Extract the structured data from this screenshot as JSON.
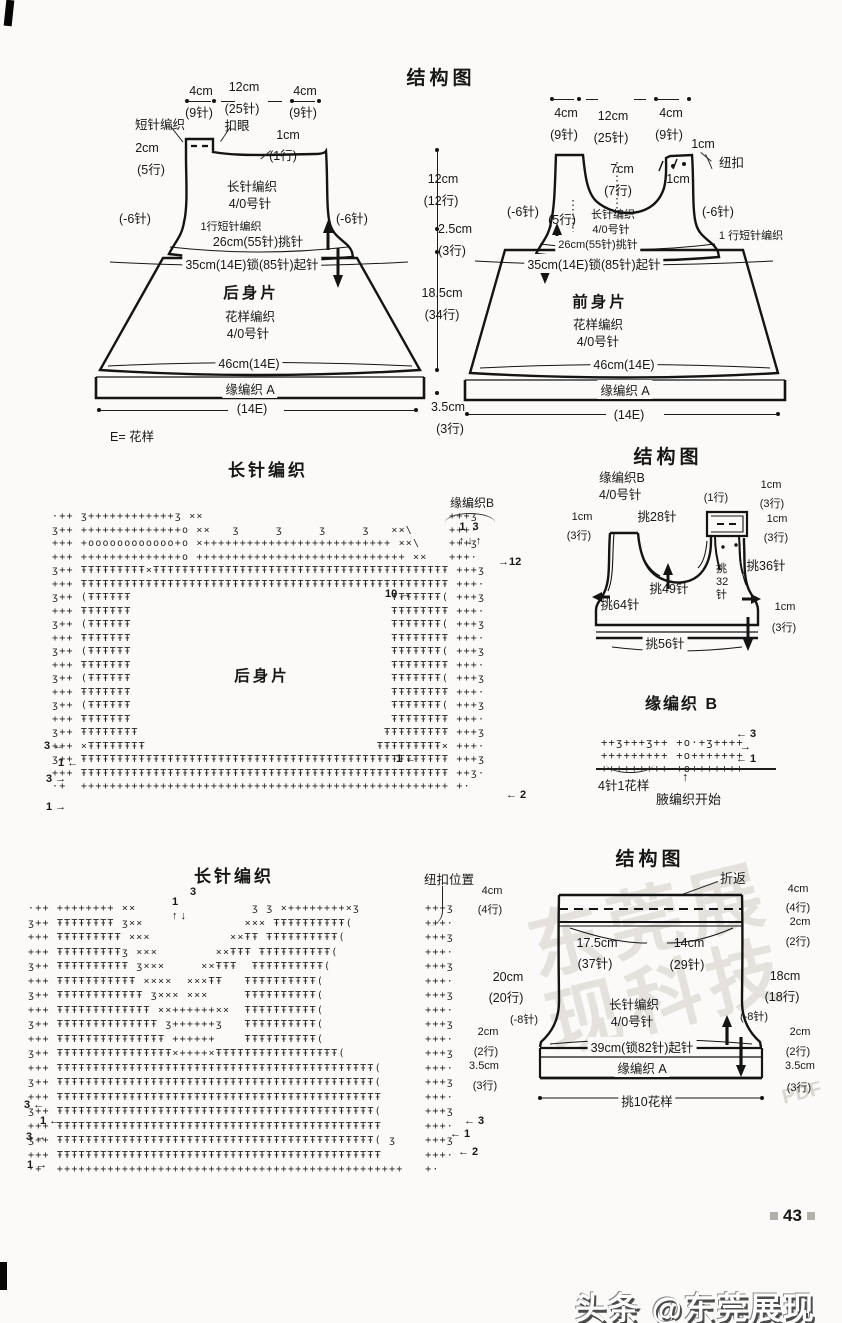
{
  "top": {
    "title": "结构图",
    "back": {
      "w_left": "4cm",
      "w_left_n": "(9针)",
      "w_mid": "12cm",
      "w_mid_n": "(25针)",
      "w_right": "4cm",
      "w_right_n": "(9针)",
      "sc_band": "短针编织",
      "buttonhole": "扣眼",
      "tab_h": "2cm",
      "tab_h_n": "(5行)",
      "edge_h": "1cm",
      "edge_h_n": "(1行)",
      "stitch": "长针编织",
      "hook": "4/0号针",
      "dec_left": "(-6针)",
      "dec_right": "(-6针)",
      "sc_row": "1行短针编织",
      "pickup": "26cm(55针)挑针",
      "cast_on": "35cm(14E)锁(85针)起针",
      "name": "后身片",
      "pattern": "花样编织",
      "hook2": "4/0号针",
      "hem_w": "46cm(14E)",
      "edging": "缘编织 A",
      "hem_dim": "(14E)",
      "legend": "E= 花样"
    },
    "front": {
      "w_left": "4cm",
      "w_left_n": "(9针)",
      "w_mid": "12cm",
      "w_mid_n": "(25针)",
      "w_right": "4cm",
      "w_right_n": "(9针)",
      "btn_h1": "1cm",
      "button": "纽扣",
      "btn_h2": "1cm",
      "neck_d": "7cm",
      "neck_d_n": "(7行)",
      "dec_left": "(-6针)",
      "rows5": "(5行)",
      "dec_right": "(-6针)",
      "stitch": "长针编织",
      "hook": "4/0号针",
      "pickup": "26cm(55针)挑针",
      "sc_row": "1 行短针编织",
      "cast_on": "35cm(14E)锁(85针)起针",
      "name": "前身片",
      "pattern": "花样编织",
      "hook2": "4/0号针",
      "hem_w": "46cm(14E)",
      "edging": "缘编织 A",
      "hem_dim": "(14E)"
    },
    "mid": {
      "h1": "12cm",
      "h1n": "(12行)",
      "h2": "2.5cm",
      "h2n": "(3行)",
      "h3": "18.5cm",
      "h3n": "(34行)",
      "h4": "3.5cm",
      "h4n": "(3行)"
    }
  },
  "chart_back": {
    "title": "长针编织",
    "edge_label": "缘编织B",
    "cols": "1   3",
    "arrows": "↑ ↓ ↑",
    "r12": "→12",
    "r10": "10 →",
    "center": "后身片",
    "ln1": "3 ←",
    "ln2": "1 ←",
    "ln3": "3 →",
    "ln4": "1 →",
    "rn1": "1 ←",
    "rn2": "← 2",
    "ascii": "·++ ʒ++++++++++++ʒ ××                                  +++ʒ\nʒ++ ++++++++++++++o ××   ʒ     ʒ     ʒ     ʒ   ××\\     +++·\n+++ +oooooooooooo+o ×++++++++++++++++++++++++++ ××\\    +++ʒ\n+++ ++++++++++++++o +++++++++++++++++++++++++++++ ××   +++·\nʒ++ ŦŦŦŦŦŦŦŦŦ×ŦŦŦŦŦŦŦŦŦŦŦŦŦŦŦŦŦŦŦŦŦŦŦŦŦŦŦŦŦŦŦŦŦŦŦŦŦŦŦŦŦ +++ʒ\n+++ ŦŦŦŦŦŦŦŦŦŦŦŦŦŦŦŦŦŦŦŦŦŦŦŦŦŦŦŦŦŦŦŦŦŦŦŦŦŦŦŦŦŦŦŦŦŦŦŦŦŦŦ +++·\nʒ++ (ŦŦŦŦŦŦ                                    ŦŦŦŦŦŦŦ( +++ʒ\n+++ ŦŦŦŦŦŦŦ                                    ŦŦŦŦŦŦŦŦ +++·\nʒ++ (ŦŦŦŦŦŦ                                    ŦŦŦŦŦŦŦ( +++ʒ\n+++ ŦŦŦŦŦŦŦ                                    ŦŦŦŦŦŦŦŦ +++·\nʒ++ (ŦŦŦŦŦŦ                                    ŦŦŦŦŦŦŦ( +++ʒ\n+++ ŦŦŦŦŦŦŦ                                    ŦŦŦŦŦŦŦŦ +++·\nʒ++ (ŦŦŦŦŦŦ                                    ŦŦŦŦŦŦŦ( +++ʒ\n+++ ŦŦŦŦŦŦŦ                                    ŦŦŦŦŦŦŦŦ +++·\nʒ++ (ŦŦŦŦŦŦ                                    ŦŦŦŦŦŦŦ( +++ʒ\n+++ ŦŦŦŦŦŦŦ                                    ŦŦŦŦŦŦŦŦ +++·\nʒ++ ŦŦŦŦŦŦŦŦ                                  ŦŦŦŦŦŦŦŦŦ +++ʒ\n+++ ×ŦŦŦŦŦŦŦŦ                                ŦŦŦŦŦŦŦŦŦ× +++·\nʒ++ ŦŦŦŦŦŦŦŦŦŦŦŦŦŦŦŦŦŦŦŦŦŦŦŦŦŦŦŦŦŦŦŦŦŦŦŦŦŦŦŦŦŦŦŦŦŦŦŦŦŦŦ +++ʒ\n+++ ŦŦŦŦŦŦŦŦŦŦŦŦŦŦŦŦŦŦŦŦŦŦŦŦŦŦŦŦŦŦŦŦŦŦŦŦŦŦŦŦŦŦŦŦŦŦŦŦŦŦŦ ++ʒ·\n·+  +++++++++++++++++++++++++++++++++++++++++++++++++++ +·"
  },
  "vest": {
    "title": "结构图",
    "edge": "缘编织B",
    "hook": "4/0号针",
    "row1": "(1行)",
    "cm_t": "1cm",
    "cm_t_n": "(3行)",
    "p28": "挑28针",
    "cm_l": "1cm",
    "cm_l_n": "(3行)",
    "cm_r": "1cm",
    "cm_r_n": "(3行)",
    "p36": "挑36针",
    "p49": "挑49针",
    "p32": "挑32针",
    "p64": "挑64针",
    "cm_b": "1cm",
    "cm_b_n": "(3行)",
    "p56": "挑56针"
  },
  "edge_b": {
    "title": "缘编织 B",
    "a3": "← 3",
    "amid": "→",
    "a1": "← 1",
    "up": "↑",
    "unit": "4针1花样",
    "start": "腋编织开始",
    "ascii": "++ʒ+++ʒ++ +o·+ʒ++++\n+++++++++ +o+++++++\n+++++++++ +o+++++++"
  },
  "chart_front": {
    "title": "长针编织",
    "btn_pos": "纽扣位置",
    "n1": "1",
    "n3": "3",
    "arr": "↑ ↓",
    "ln1": "3 ←",
    "ln2": "1 ←",
    "ln3": "3 →",
    "ln4": "1 →",
    "rn1": "← 3",
    "rn2": "← 1",
    "rn3": "← 2",
    "ascii": "·++ ++++++++ ××                ʒ ʒ ×++++++++×ʒ         +++ʒ\nʒ++ ŦŦŦŦŦŦŦŦ ʒ××              ××× ŦŦŦŦŦŦŦŦŦŦ(          +++·\n+++ ŦŦŦŦŦŦŦŦŦ ×××           ××ŦŦ ŦŦŦŦŦŦŦŦŦŦ(           +++ʒ\n+++ ŦŦŦŦŦŦŦŦŦʒ ×××        ××ŦŦŦ ŦŦŦŦŦŦŦŦŦŦ(            +++·\nʒ++ ŦŦŦŦŦŦŦŦŦŦ ʒ×××     ××ŦŦŦ  ŦŦŦŦŦŦŦŦŦŦ(             +++ʒ\n+++ ŦŦŦŦŦŦŦŦŦŦŦ ××××  ×××ŦŦ   ŦŦŦŦŦŦŦŦŦŦ(              +++·\nʒ++ ŦŦŦŦŦŦŦŦŦŦŦŦ ʒ××× ×××     ŦŦŦŦŦŦŦŦŦŦ(              +++ʒ\n+++ ŦŦŦŦŦŦŦŦŦŦŦŦŦ ××++++++××  ŦŦŦŦŦŦŦŦŦŦ(              +++·\nʒ++ ŦŦŦŦŦŦŦŦŦŦŦŦŦŦ ʒ++++++ʒ   ŦŦŦŦŦŦŦŦŦŦ(              +++ʒ\n+++ ŦŦŦŦŦŦŦŦŦŦŦŦŦŦŦ ++++++    ŦŦŦŦŦŦŦŦŦŦ(              +++·\nʒ++ ŦŦŦŦŦŦŦŦŦŦŦŦŦŦŦŦ×++++×ŦŦŦŦŦŦŦŦŦŦŦŦŦŦŦŦŦ(           +++ʒ\n+++ ŦŦŦŦŦŦŦŦŦŦŦŦŦŦŦŦŦŦŦŦŦŦŦŦŦŦŦŦŦŦŦŦŦŦŦŦŦŦŦŦŦŦŦŦ(      +++·\nʒ++ ŦŦŦŦŦŦŦŦŦŦŦŦŦŦŦŦŦŦŦŦŦŦŦŦŦŦŦŦŦŦŦŦŦŦŦŦŦŦŦŦŦŦŦŦ(      +++ʒ\n+++ ŦŦŦŦŦŦŦŦŦŦŦŦŦŦŦŦŦŦŦŦŦŦŦŦŦŦŦŦŦŦŦŦŦŦŦŦŦŦŦŦŦŦŦŦŦ      +++·\nʒ++ ŦŦŦŦŦŦŦŦŦŦŦŦŦŦŦŦŦŦŦŦŦŦŦŦŦŦŦŦŦŦŦŦŦŦŦŦŦŦŦŦŦŦŦŦ(      +++ʒ\n+++ ŦŦŦŦŦŦŦŦŦŦŦŦŦŦŦŦŦŦŦŦŦŦŦŦŦŦŦŦŦŦŦŦŦŦŦŦŦŦŦŦŦŦŦŦŦ      +++·\nʒ++ ŦŦŦŦŦŦŦŦŦŦŦŦŦŦŦŦŦŦŦŦŦŦŦŦŦŦŦŦŦŦŦŦŦŦŦŦŦŦŦŦŦŦŦŦ( ʒ    +++ʒ\n+++ ŦŦŦŦŦŦŦŦŦŦŦŦŦŦŦŦŦŦŦŦŦŦŦŦŦŦŦŦŦŦŦŦŦŦŦŦŦŦŦŦŦŦŦŦŦ      +++·\n·+  ++++++++++++++++++++++++++++++++++++++++++++++++   +·"
  },
  "skirt": {
    "title": "结构图",
    "fold": "折返",
    "l4": "4cm",
    "l4n": "(4行)",
    "r4": "4cm",
    "r4n": "(4行)",
    "r2": "2cm",
    "r2n": "(2行)",
    "w1": "17.5cm",
    "w1n": "(37针)",
    "w2": "14cm",
    "w2n": "(29针)",
    "hl": "20cm",
    "hln": "(20行)",
    "hr": "18cm",
    "hrn": "(18行)",
    "stitch": "长针编织",
    "hook": "4/0号针",
    "dec_l": "(-8针)",
    "dec_r": "(-8针)",
    "bl2": "2cm",
    "bl2n": "(2行)",
    "bl35": "3.5cm",
    "bl35n": "(3行)",
    "br2": "2cm",
    "br2n": "(2行)",
    "br35": "3.5cm",
    "br35n": "(3行)",
    "cast_on": "39cm(锁82针)起针",
    "edging": "缘编织 A",
    "pickup": "挑10花样"
  },
  "footer": {
    "page": "43",
    "band": "头条 @东莞展现科技",
    "stamp": "东莞展现科技",
    "stamp2": "PDF"
  }
}
